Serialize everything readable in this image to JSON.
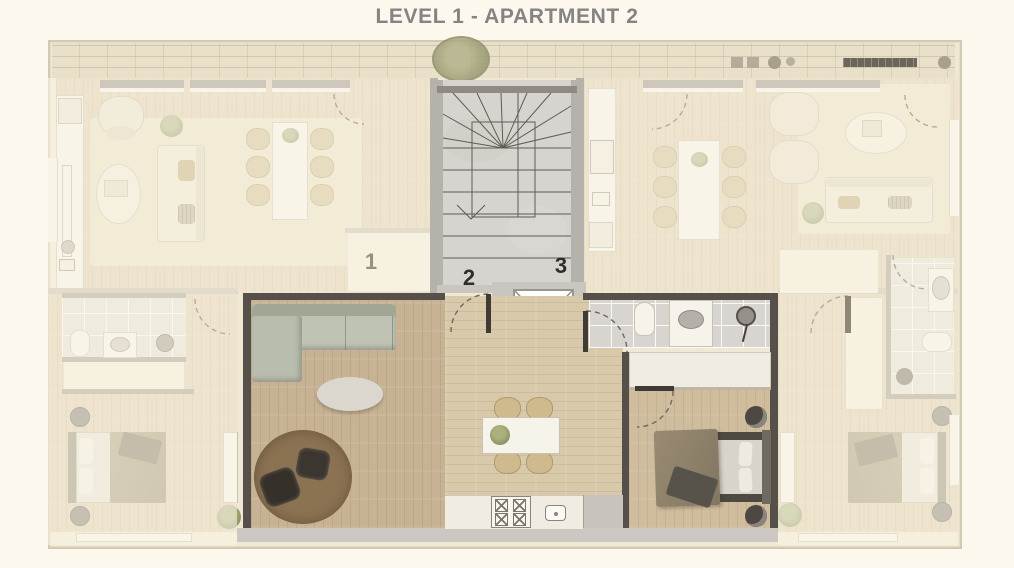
{
  "title": "LEVEL 1 - APARTMENT 2",
  "plan": {
    "level": "LEVEL 1",
    "highlighted_unit": "2",
    "units": [
      {
        "label": "1"
      },
      {
        "label": "2"
      },
      {
        "label": "3"
      }
    ]
  },
  "palette": {
    "background": "#fcf8ee",
    "title_text": "#848484",
    "faded_overlay": "#faf4e5",
    "brick_band": "#e9e0ca",
    "apartment_wall_dark": "#55504a",
    "living_floor_wood": "#c7b394",
    "dining_floor_wood": "#d9c9ab",
    "bedroom_floor_wood": "#cfbd9e",
    "stair_floor": "#d7d4cf",
    "rug_brown": "#8b7252",
    "sofa_gray_green": "#bfc3b3",
    "dark_chair": "#3b362f",
    "bathroom_tile": "#d8d5d0",
    "counter_white": "#f1ece1",
    "bed_blanket_olive": "#968870",
    "elevator_cab": "#fdfdfb",
    "unit_label_dark": "#312e29",
    "unit_label_faded": "#97907f"
  }
}
